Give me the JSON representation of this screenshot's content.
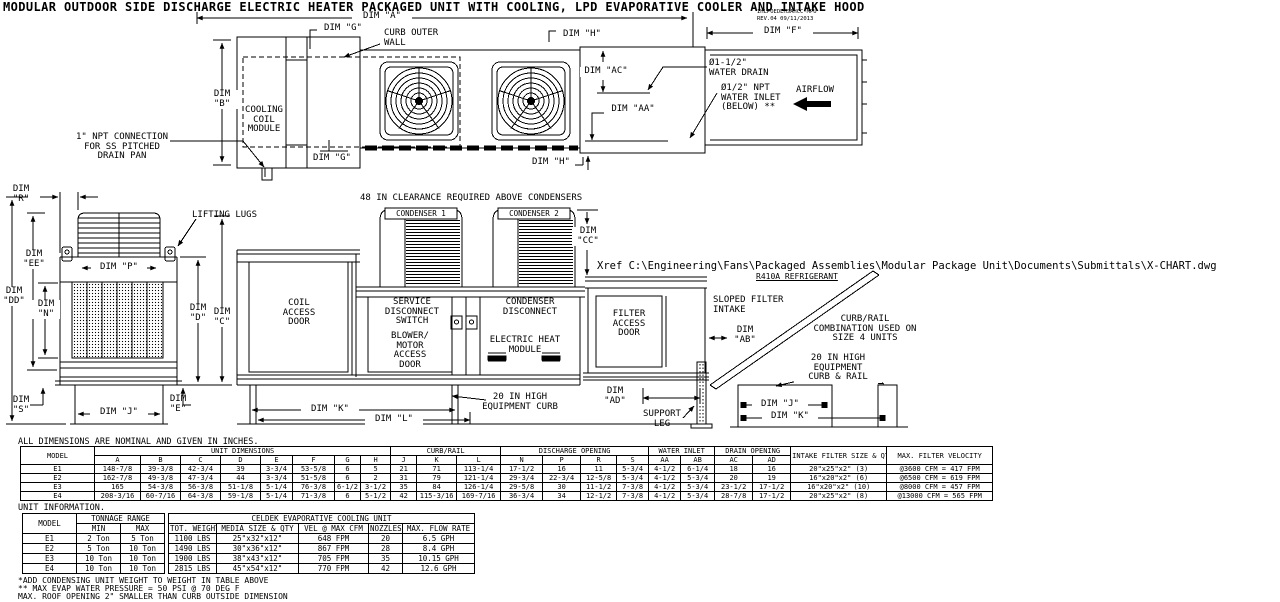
{
  "title": "MODULAR OUTDOOR SIDE DISCHARGE ELECTRIC HEATER PACKAGED UNIT WITH COOLING, LPD EVAPORATIVE COOLER AND INTAKE HOOD",
  "rev": {
    "code": "IHLPOEDEHSAHCC-MPU",
    "date": "REV.04   09/11/2013"
  },
  "labels": {
    "dim_a": "DIM \"A\"",
    "dim_g_top": "DIM \"G\"",
    "dim_g_bottom": "DIM \"G\"",
    "dim_h_top": "DIM \"H\"",
    "dim_h_bottom": "DIM \"H\"",
    "dim_f": "DIM \"F\"",
    "dim_b": "DIM\n\"B\"",
    "dim_ac": "DIM \"AC\"",
    "dim_aa": "DIM \"AA\"",
    "curb_outer_wall": "CURB OUTER\nWALL",
    "cooling_coil_module": "COOLING\nCOIL\nMODULE",
    "water_drain": "Ø1-1/2\"\nWATER DRAIN",
    "water_inlet": "Ø1/2\" NPT\nWATER INLET\n(BELOW) **",
    "airflow": "AIRFLOW",
    "npt_connection": "1\" NPT CONNECTION\nFOR SS PITCHED\nDRAIN PAN",
    "dim_r": "DIM\n\"R\"",
    "lifting_lugs": "LIFTING LUGS",
    "dim_p": "DIM \"P\"",
    "dim_ee": "DIM\n\"EE\"",
    "dim_dd": "DIM\n\"DD\"",
    "dim_n": "DIM\n\"N\"",
    "dim_d": "DIM\n\"D\"",
    "dim_c": "DIM\n\"C\"",
    "dim_s": "DIM\n\"S\"",
    "dim_j_left": "DIM \"J\"",
    "dim_e": "DIM\n\"E\"",
    "clearance": "48 IN CLEARANCE REQUIRED ABOVE CONDENSERS",
    "condenser1": "CONDENSER 1",
    "condenser2": "CONDENSER 2",
    "dim_cc": "DIM\n\"CC\"",
    "coil_access_door": "COIL\nACCESS\nDOOR",
    "service_disconnect": "SERVICE\nDISCONNECT\nSWITCH",
    "condenser_disconnect": "CONDENSER\nDISCONNECT",
    "blower_motor": "BLOWER/\nMOTOR\nACCESS\nDOOR",
    "electric_heat": "ELECTRIC HEAT\nMODULE",
    "dim_k_center": "DIM \"K\"",
    "dim_l": "DIM \"L\"",
    "curb_20": "20 IN HIGH\nEQUIPMENT CURB",
    "xref": "Xref C:\\Engineering\\Fans\\Packaged Assemblies\\Modular Package Unit\\Documents\\Submittals\\X-CHART.dwg",
    "r410a": "R410A REFRIGERANT",
    "filter_access_door": "FILTER\nACCESS\nDOOR",
    "sloped_filter": "SLOPED FILTER\nINTAKE",
    "dim_ab": "DIM\n\"AB\"",
    "dim_ad": "DIM\n\"AD\"",
    "support_leg": "SUPPORT\nLEG",
    "curb_rail_combo": "CURB/RAIL\nCOMBINATION USED ON\nSIZE 4 UNITS",
    "curb_rail_20": "20 IN HIGH\nEQUIPMENT\nCURB & RAIL",
    "dim_j_detail": "DIM \"J\"",
    "dim_k_detail": "DIM \"K\""
  },
  "notes": {
    "dims": "ALL DIMENSIONS ARE NOMINAL AND GIVEN IN INCHES.",
    "unit_info": "UNIT INFORMATION.",
    "fn1": "*ADD CONDENSING UNIT WEIGHT TO WEIGHT IN TABLE ABOVE",
    "fn2": "** MAX EVAP WATER PRESSURE = 50 PSI @ 70 DEG F",
    "fn3": "MAX. ROOF OPENING 2\" SMALLER THAN CURB OUTSIDE DIMENSION"
  },
  "dim_table": {
    "model": "MODEL",
    "g_unit": "UNIT DIMENSIONS",
    "g_curb": "CURB/RAIL",
    "g_discharge": "DISCHARGE OPENING",
    "g_water": "WATER INLET",
    "g_drain": "DRAIN OPENING",
    "h_filter": "INTAKE FILTER SIZE & QTY",
    "h_velocity": "MAX. FILTER VELOCITY",
    "columns": [
      "A",
      "B",
      "C",
      "D",
      "E",
      "F",
      "G",
      "H",
      "J",
      "K",
      "L",
      "N",
      "P",
      "R",
      "S",
      "AA",
      "AB",
      "AC",
      "AD"
    ],
    "rows": [
      [
        "E1",
        "148-7/8",
        "39-3/8",
        "42-3/4",
        "39",
        "3-3/4",
        "53-5/8",
        "6",
        "5",
        "21",
        "71",
        "113-1/4",
        "17-1/2",
        "16",
        "11",
        "5-3/4",
        "4-1/2",
        "6-1/4",
        "18",
        "16",
        "20\"x25\"x2\" (3)",
        "@3600 CFM = 417 FPM"
      ],
      [
        "E2",
        "162-7/8",
        "49-3/8",
        "47-3/4",
        "44",
        "3-3/4",
        "51-5/8",
        "6",
        "2",
        "31",
        "79",
        "121-1/4",
        "29-3/4",
        "22-3/4",
        "12-5/8",
        "5-3/4",
        "4-1/2",
        "5-3/4",
        "20",
        "19",
        "16\"x20\"x2\" (6)",
        "@6500 CFM = 619 FPM"
      ],
      [
        "E3",
        "165",
        "54-3/8",
        "56-3/8",
        "51-1/8",
        "5-1/4",
        "76-3/8",
        "6-1/2",
        "3-1/2",
        "35",
        "84",
        "126-1/4",
        "29-5/8",
        "30",
        "11-1/2",
        "7-3/8",
        "4-1/2",
        "5-3/4",
        "23-1/2",
        "17-1/2",
        "16\"x20\"x2\" (10)",
        "@8000 CFM = 457 FPM"
      ],
      [
        "E4",
        "208-3/16",
        "60-7/16",
        "64-3/8",
        "59-1/8",
        "5-1/4",
        "71-3/8",
        "6",
        "5-1/2",
        "42",
        "115-3/16",
        "169-7/16",
        "36-3/4",
        "34",
        "12-1/2",
        "7-3/8",
        "4-1/2",
        "5-3/4",
        "28-7/8",
        "17-1/2",
        "20\"x25\"x2\" (8)",
        "@13000 CFM = 565 FPM"
      ]
    ]
  },
  "info_table": {
    "model": "MODEL",
    "tonnage": "TONNAGE RANGE",
    "min": "MIN",
    "max": "MAX",
    "rows": [
      [
        "E1",
        "2 Ton",
        "5 Ton"
      ],
      [
        "E2",
        "5 Ton",
        "10 Ton"
      ],
      [
        "E3",
        "10 Ton",
        "10 Ton"
      ],
      [
        "E4",
        "10 Ton",
        "10 Ton"
      ]
    ],
    "celdek": {
      "title": "CELDEK EVAPORATIVE COOLING UNIT",
      "columns": [
        "TOT. WEIGHT",
        "MEDIA SIZE & QTY",
        "VEL @ MAX CFM",
        "NOZZLES",
        "MAX. FLOW RATE"
      ],
      "rows": [
        [
          "1100 LBS",
          "25\"x32\"x12\"",
          "648 FPM",
          "20",
          "6.5 GPH"
        ],
        [
          "1490 LBS",
          "30\"x36\"x12\"",
          "867 FPM",
          "28",
          "8.4 GPH"
        ],
        [
          "1900 LBS",
          "38\"x43\"x12\"",
          "705 FPM",
          "35",
          "10.15 GPH"
        ],
        [
          "2815 LBS",
          "45\"x54\"x12\"",
          "770 FPM",
          "42",
          "12.6 GPH"
        ]
      ]
    }
  }
}
